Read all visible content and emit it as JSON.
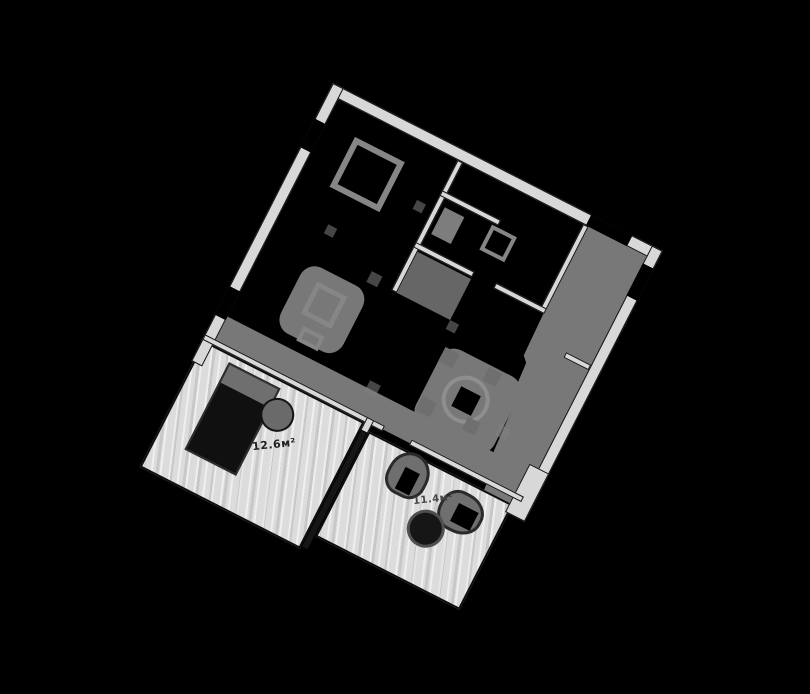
{
  "scene": {
    "type": "rotated apartment floor plan on black background",
    "background": "#000000"
  },
  "colors": {
    "background": "#000000",
    "wall": "#d8d8d8",
    "wall_outline": "#141414",
    "dark_floor": "#787878",
    "light_floor": "#dcdcdc",
    "furniture_gray": "#868686",
    "furniture_dark": "#141414",
    "label_text": "#222222"
  },
  "rooms": [
    {
      "name": "office-room",
      "area_label": "12.6м²"
    },
    {
      "name": "lounge-room",
      "area_label": "11.4м²"
    }
  ]
}
